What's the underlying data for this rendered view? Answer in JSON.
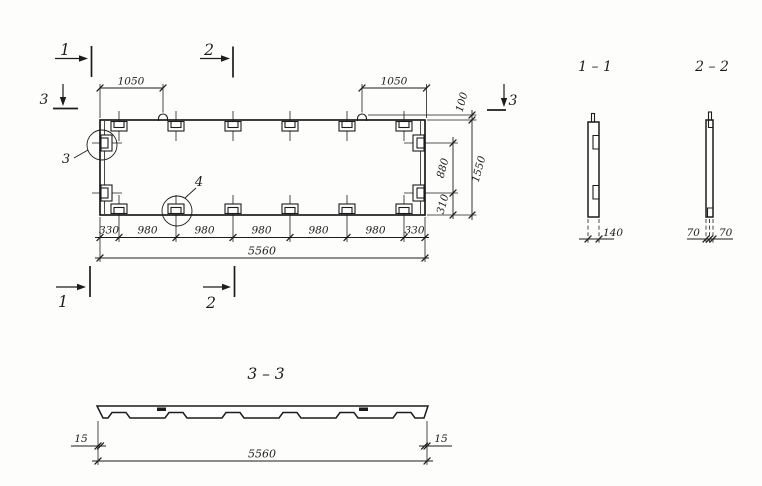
{
  "colors": {
    "ink": "#1c1c1c",
    "paper": "#fdfdfc"
  },
  "plan": {
    "cut_top_1": "1",
    "cut_top_2": "2",
    "cut_bottom_1": "1",
    "cut_bottom_2": "2",
    "cut_left_3": "3",
    "cut_right_3": "3",
    "detail_3": "3",
    "detail_4": "4",
    "dim_top_left": "1050",
    "dim_top_right": "1050",
    "dim_right_100": "100",
    "dim_right_880": "880",
    "dim_right_310": "310",
    "dim_right_overall": "1550",
    "dim_bottom": [
      "330",
      "980",
      "980",
      "980",
      "980",
      "980",
      "330"
    ],
    "dim_bottom_overall": "5560"
  },
  "section_11": {
    "title": "1 – 1",
    "dim": "140"
  },
  "section_22": {
    "title": "2 – 2",
    "dim_left": "70",
    "dim_right": "70"
  },
  "section_33": {
    "title": "3 – 3",
    "dim_left": "15",
    "dim_right": "15",
    "dim_overall": "5560"
  }
}
